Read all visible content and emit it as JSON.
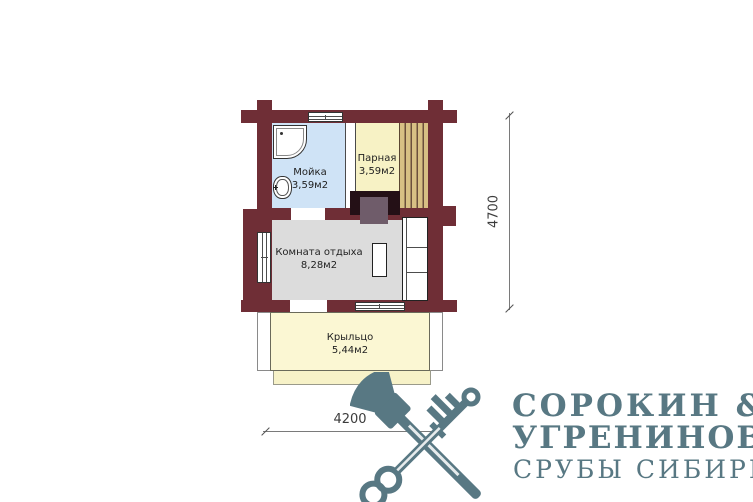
{
  "plan": {
    "rooms": [
      {
        "name": "Мойка",
        "area": "3,59м2"
      },
      {
        "name": "Парная",
        "area": "3,59м2"
      },
      {
        "name": "Комната отдыха",
        "area": "8,28м2"
      },
      {
        "name": "Крыльцо",
        "area": "5,44м2"
      }
    ],
    "dimensions": {
      "width": "4200",
      "height": "4700"
    },
    "colors": {
      "wall": "#6f2e36",
      "moyka_floor": "#cfe3f6",
      "parnaya_floor": "#f7f2c5",
      "bench_plank": "#d8c084",
      "komnata_floor": "#dcdcdc",
      "kryltso_floor": "#fbf7d3",
      "stove_outer": "#241016",
      "stove_inner": "#6f5c6a",
      "logo": "#587883"
    }
  },
  "logo": {
    "line1": "СОРОКИН &",
    "line2": "УГРЕНИНОВ",
    "line3": "СРУБЫ СИБИРИ"
  },
  "icons": {
    "axe": "axe-icon",
    "key": "key-icon"
  }
}
